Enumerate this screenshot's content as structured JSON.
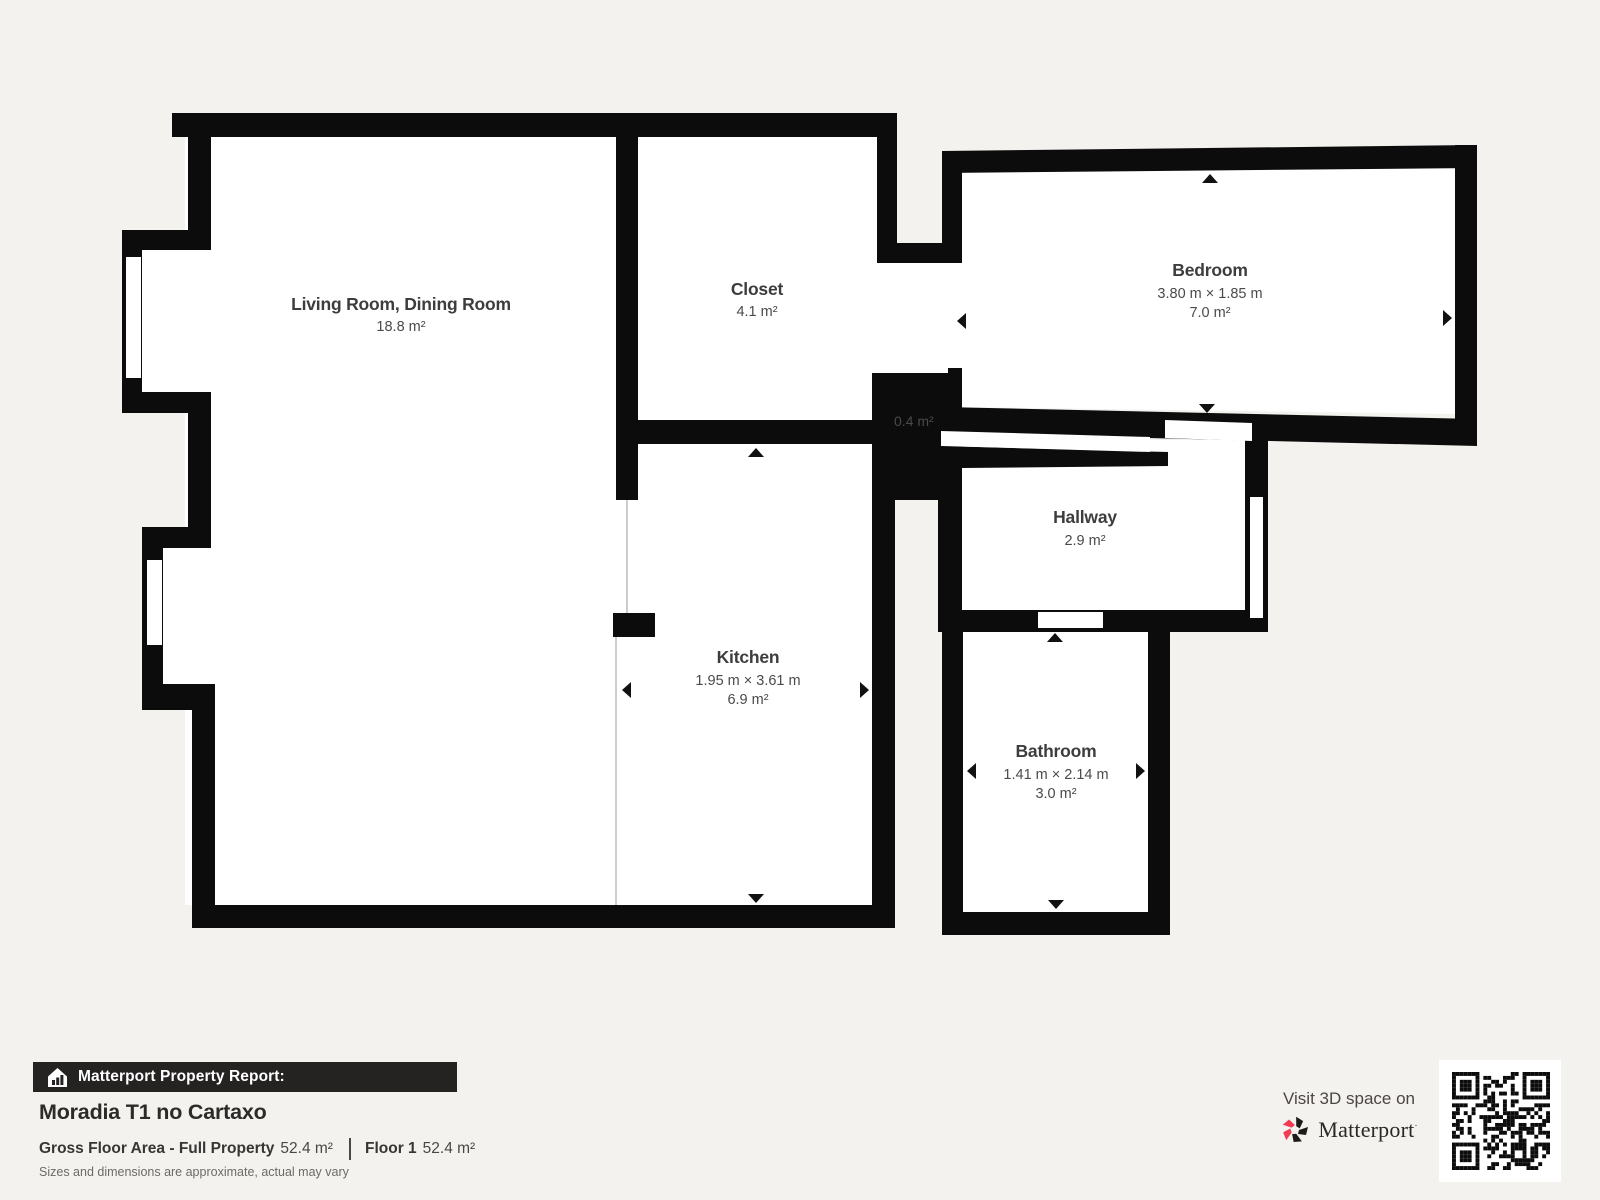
{
  "plan": {
    "rooms": [
      {
        "name": "Living Room, Dining Room",
        "dims": "",
        "area": "18.8 m²"
      },
      {
        "name": "Closet",
        "dims": "",
        "area": "4.1 m²"
      },
      {
        "name": "Bedroom",
        "dims": "3.80 m × 1.85 m",
        "area": "7.0 m²"
      },
      {
        "name": "Hallway",
        "dims": "",
        "area": "2.9 m²"
      },
      {
        "name": "Kitchen",
        "dims": "1.95 m × 3.61 m",
        "area": "6.9 m²"
      },
      {
        "name": "Bathroom",
        "dims": "1.41 m × 2.14 m",
        "area": "3.0 m²"
      },
      {
        "name": "",
        "dims": "",
        "area": "0.4 m²"
      }
    ]
  },
  "footer": {
    "report_label": "Matterport Property Report:",
    "property_title": "Moradia T1 no Cartaxo",
    "gross_label": "Gross Floor Area - Full Property",
    "gross_value": "52.4 m²",
    "floor_label": "Floor 1",
    "floor_value": "52.4 m²",
    "disclaimer": "Sizes and dimensions are approximate, actual may vary"
  },
  "cta": {
    "visit_text": "Visit 3D space on",
    "brand": "Matterport",
    "brand_mark": "·"
  },
  "colors": {
    "background": "#f4f2ef",
    "wall": "#0c0c0c",
    "floor": "#ffffff",
    "label": "#3d3d3d",
    "banner": "#252222",
    "logo_red": "#f23b53"
  }
}
